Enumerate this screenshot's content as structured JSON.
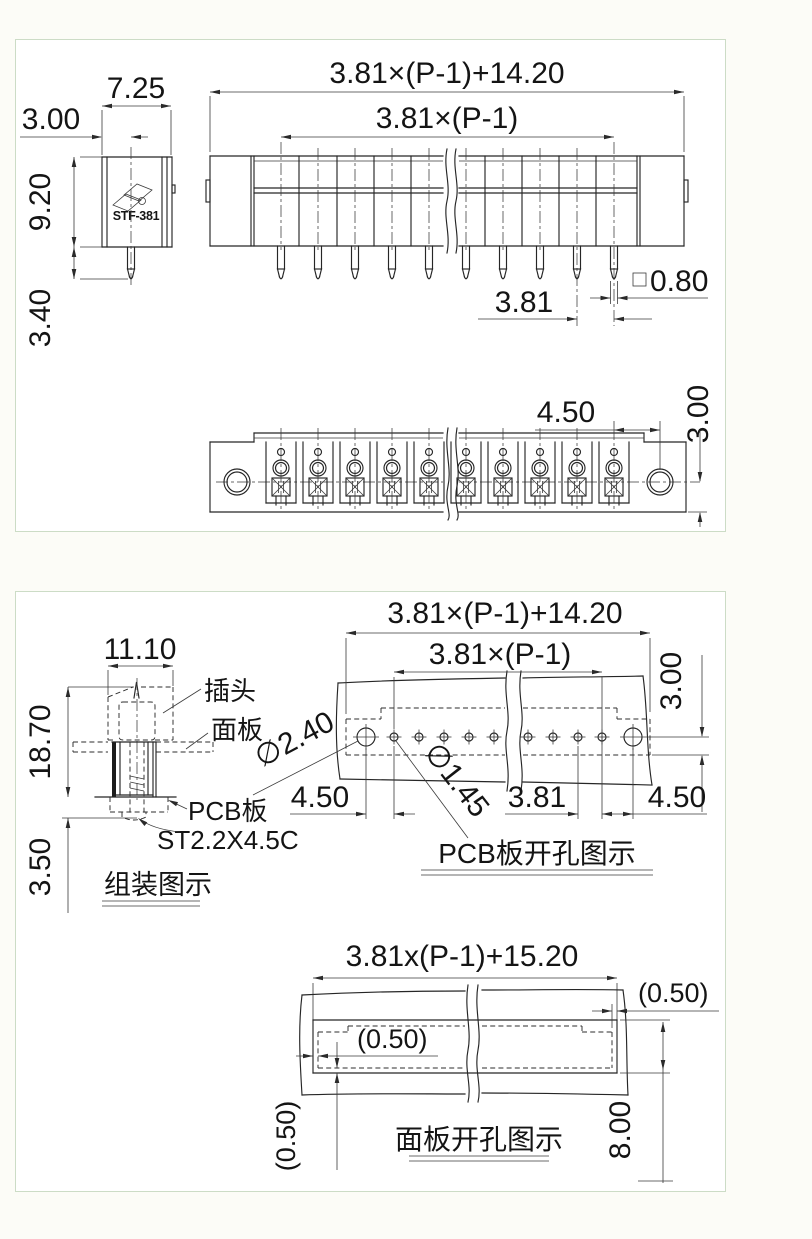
{
  "sheet1": {
    "side": {
      "model": "STF-381",
      "dim_width": "7.25",
      "dim_pin_offset": "3.00",
      "dim_height": "9.20",
      "dim_pin_length": "3.40"
    },
    "front": {
      "dim_total": "3.81×(P-1)+14.20",
      "dim_pitch_span": "3.81×(P-1)",
      "dim_pitch": "3.81",
      "dim_pin_square": "0.80"
    },
    "top": {
      "dim_hole_offset": "4.50",
      "dim_center_to_edge": "3.00"
    }
  },
  "sheet2": {
    "assembly": {
      "dim_width": "11.10",
      "dim_height": "18.70",
      "dim_pin_below": "3.50",
      "label_plug": "插头",
      "label_panel": "面板",
      "label_pcb": "PCB板",
      "label_screw": "ST2.2X4.5C",
      "title": "组装图示"
    },
    "pcb": {
      "dim_total": "3.81×(P-1)+14.20",
      "dim_pitch_span": "3.81×(P-1)",
      "dim_edge": "3.00",
      "dim_hole_big": "∅2.40",
      "dim_hole_small": "∅1.45",
      "dim_end_left": "4.50",
      "dim_pitch": "3.81",
      "dim_end_right": "4.50",
      "title": "PCB板开孔图示"
    },
    "cutout": {
      "dim_total": "3.81x(P-1)+15.20",
      "dim_gap_top": "(0.50)",
      "dim_gap_inner": "(0.50)",
      "dim_gap_side": "(0.50)",
      "dim_height": "8.00",
      "title": "面板开孔图示"
    }
  }
}
